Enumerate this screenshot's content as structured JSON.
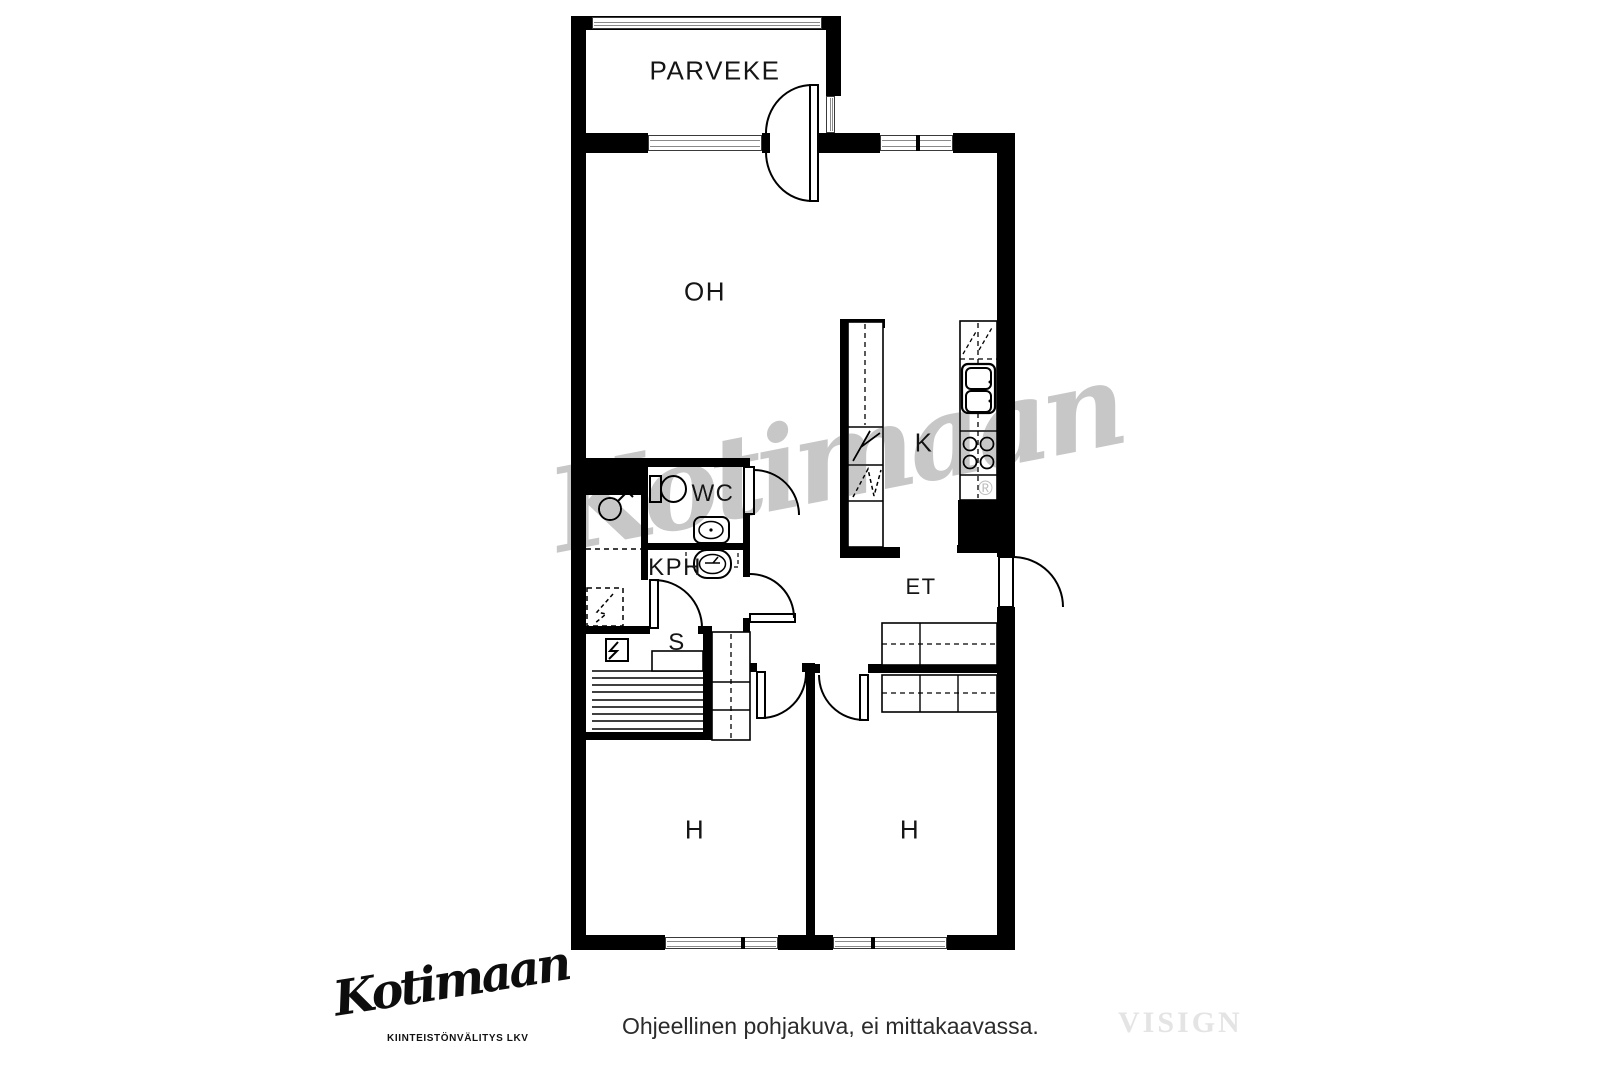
{
  "plan": {
    "rooms": [
      {
        "id": "parveke",
        "label": "PARVEKE"
      },
      {
        "id": "oh",
        "label": "OH"
      },
      {
        "id": "k",
        "label": "K"
      },
      {
        "id": "wc",
        "label": "WC"
      },
      {
        "id": "kph",
        "label": "KPH"
      },
      {
        "id": "et",
        "label": "ET"
      },
      {
        "id": "s",
        "label": "S"
      },
      {
        "id": "h1",
        "label": "H"
      },
      {
        "id": "h2",
        "label": "H"
      }
    ],
    "watermark": {
      "script": "Kotimaan",
      "registered": "®"
    }
  },
  "footer": {
    "logo": {
      "script": "Kotimaan",
      "subtitle": "KIINTEISTÖNVÄLITYS LKV"
    },
    "disclaimer": "Ohjeellinen pohjakuva, ei mittakaavassa.",
    "brand_watermark": "VISIGN"
  },
  "colors": {
    "wall": "#000000",
    "label": "#151515",
    "plan_watermark": "#c7c7c7",
    "brand_watermark": "#e4e4e4",
    "background": "#ffffff"
  }
}
